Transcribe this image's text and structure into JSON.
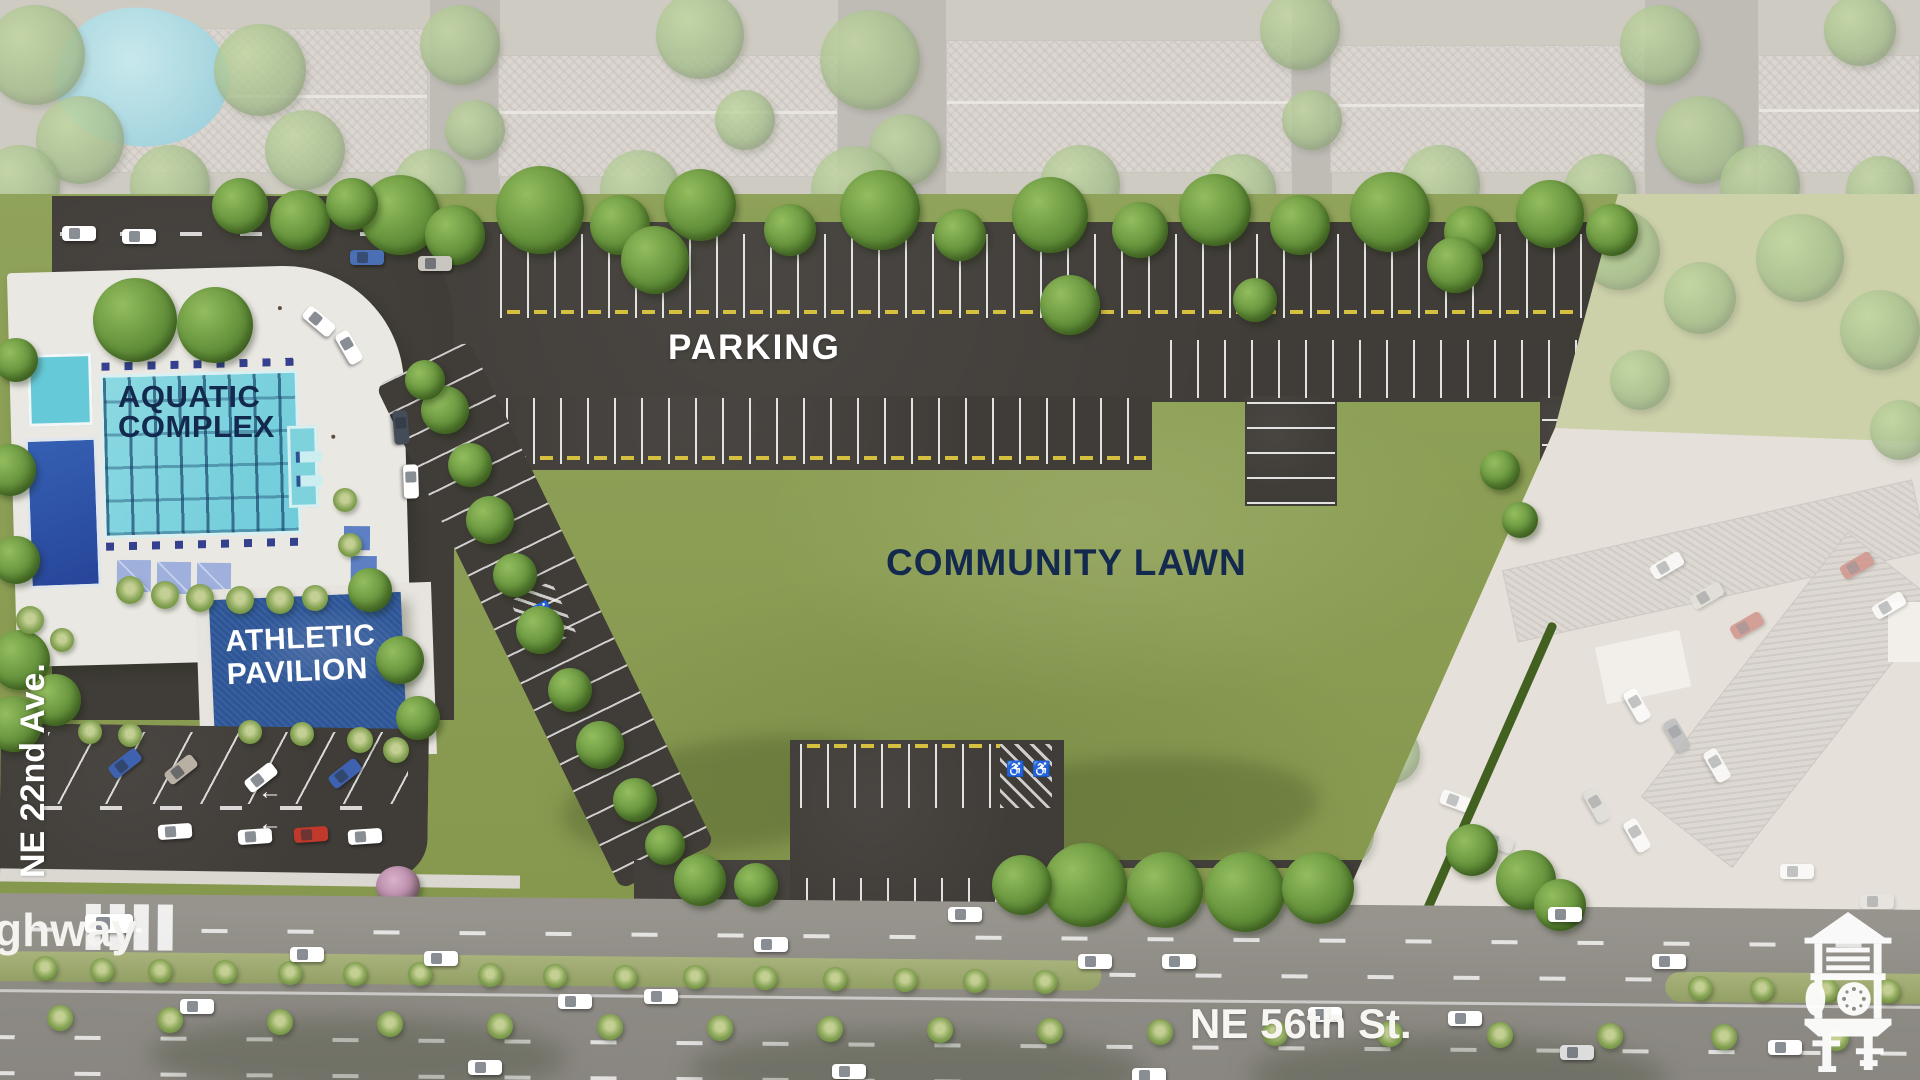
{
  "page": {
    "title": "Community Park Site Plan Rendering"
  },
  "labels": {
    "parking": "PARKING",
    "aquatic_line1": "AQUATIC",
    "aquatic_line2": "COMPLEX",
    "pavilion_line1": "ATHLETIC",
    "pavilion_line2": "PAVILION",
    "community_lawn": "COMMUNITY LAWN",
    "street_left": "NE 22nd Ave.",
    "street_bottom": "NE 56th St.",
    "street_partial": "ghway"
  },
  "logo": {
    "name": "clock-tower-logo"
  },
  "colors": {
    "label_navy": "#14294e",
    "label_white": "#ffffff",
    "lawn_green": "#8ca05a",
    "asphalt": "#403c38",
    "road_gray": "#8e8b85",
    "pool_aqua": "#7dd2dc",
    "deep_pool_blue": "#2c55a4",
    "pavilion_blue": "#2e5697"
  }
}
